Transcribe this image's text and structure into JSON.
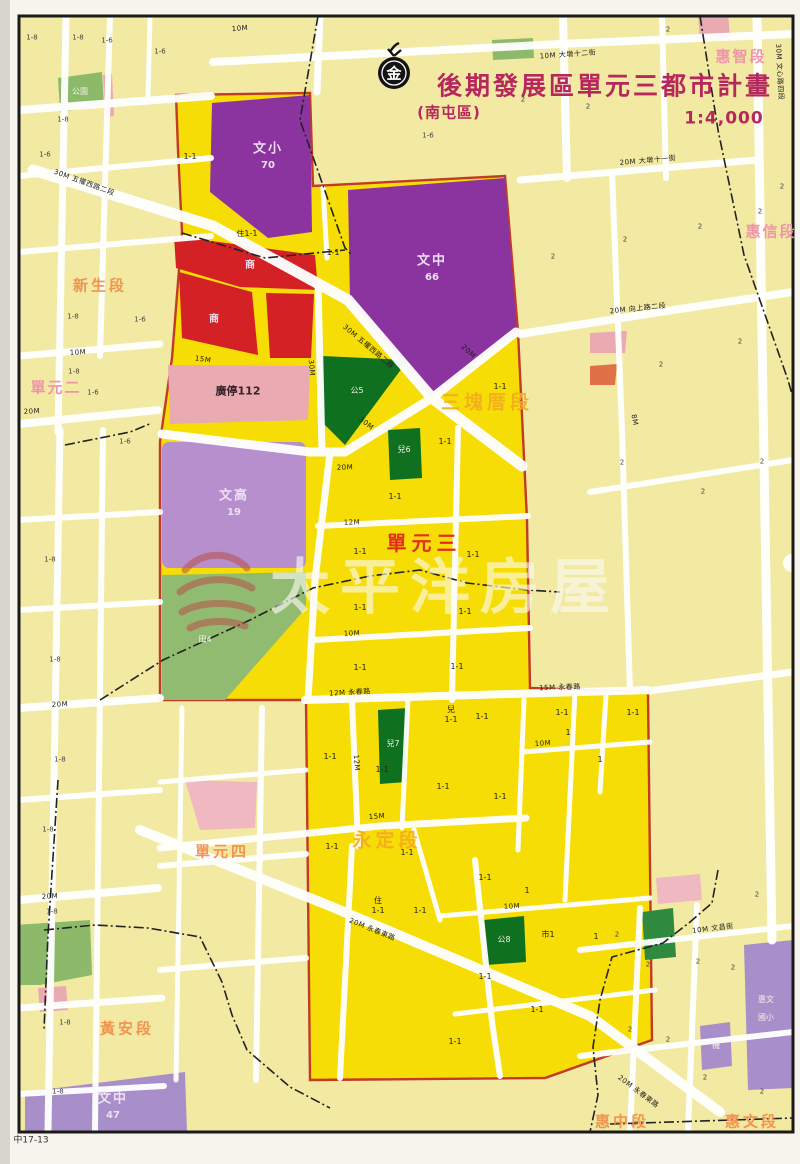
{
  "header": {
    "logo_char": "金",
    "title": "後期發展區單元三都市計畫",
    "subtitle": "(南屯區)",
    "scale": "1:4,000"
  },
  "watermark": {
    "text": "太平洋房屋"
  },
  "plate_no": "中17-13",
  "map": {
    "colors": {
      "photo_bg": "#eae8e0",
      "sheet": "#f6f4ec",
      "frame": "#1a1a1a",
      "bright": "#f6dd05",
      "pale": "#f2e9a2",
      "street": "#ffffff",
      "purple": "#8b34a0",
      "light_purple": "#b78fcd",
      "lavender": "#a98fc9",
      "red_zone": "#d42125",
      "pink_zone": "#e9aab2",
      "pink_light": "#f0b8c0",
      "dark_green": "#0f7020",
      "mid_green": "#2f8a40",
      "soft_green": "#8cba6a",
      "field_green": "#92bb72",
      "boundary_red": "#c23b28",
      "title": "#b6275c",
      "seg_orange": "#f28c4a",
      "seg_yellow": "#f3ac20",
      "seg_pink": "#ef95aa",
      "unit_red": "#e52c20",
      "watermark_logo": "#b85048"
    },
    "labels": [
      {
        "x": 605,
        "y": 86,
        "t": "後期發展區單元三都市計畫",
        "c": "ttl"
      },
      {
        "x": 449,
        "y": 113,
        "t": "(南屯區)",
        "c": "ttl2"
      },
      {
        "x": 724,
        "y": 119,
        "t": "1:4,000",
        "c": "ttl3"
      },
      {
        "x": 394,
        "y": 74,
        "t": "金",
        "c": "logo-ch"
      },
      {
        "x": 445,
        "y": 588,
        "t": "太平洋房屋",
        "c": "wm"
      },
      {
        "x": 31,
        "y": 1141,
        "t": "中17-13",
        "c": "plate"
      },
      {
        "x": 100,
        "y": 286,
        "t": "新生段",
        "c": "sg-o"
      },
      {
        "x": 56,
        "y": 388,
        "t": "單元二",
        "c": "sg-p"
      },
      {
        "x": 741,
        "y": 57,
        "t": "惠智段",
        "c": "sg-p"
      },
      {
        "x": 771,
        "y": 232,
        "t": "惠信段",
        "c": "sg-p"
      },
      {
        "x": 487,
        "y": 403,
        "t": "三塊厝段",
        "c": "sg-o2"
      },
      {
        "x": 424,
        "y": 543,
        "t": "單元三",
        "c": "sg-r"
      },
      {
        "x": 387,
        "y": 841,
        "t": "永定段",
        "c": "sg-o2"
      },
      {
        "x": 222,
        "y": 852,
        "t": "單元四",
        "c": "sg-o"
      },
      {
        "x": 127,
        "y": 1029,
        "t": "黃安段",
        "c": "sg-o"
      },
      {
        "x": 622,
        "y": 1122,
        "t": "惠中段",
        "c": "sg-o"
      },
      {
        "x": 752,
        "y": 1122,
        "t": "惠文段",
        "c": "sg-o"
      },
      {
        "x": 268,
        "y": 149,
        "t": "文小",
        "c": "wz"
      },
      {
        "x": 268,
        "y": 166,
        "t": "70",
        "c": "wz2"
      },
      {
        "x": 432,
        "y": 261,
        "t": "文中",
        "c": "wz"
      },
      {
        "x": 432,
        "y": 278,
        "t": "66",
        "c": "wz2"
      },
      {
        "x": 234,
        "y": 496,
        "t": "文高",
        "c": "wz"
      },
      {
        "x": 234,
        "y": 513,
        "t": "19",
        "c": "wz2"
      },
      {
        "x": 113,
        "y": 1099,
        "t": "文中",
        "c": "wz"
      },
      {
        "x": 113,
        "y": 1116,
        "t": "47",
        "c": "wz2"
      },
      {
        "x": 250,
        "y": 266,
        "t": "商",
        "c": "wz2"
      },
      {
        "x": 214,
        "y": 320,
        "t": "商",
        "c": "wz2"
      },
      {
        "x": 238,
        "y": 391,
        "t": "廣停112",
        "c": "pk"
      },
      {
        "x": 357,
        "y": 391,
        "t": "公5",
        "c": "wzt"
      },
      {
        "x": 404,
        "y": 450,
        "t": "兒6",
        "c": "wzt"
      },
      {
        "x": 393,
        "y": 744,
        "t": "兒7",
        "c": "wzt"
      },
      {
        "x": 504,
        "y": 940,
        "t": "公8",
        "c": "wzt"
      },
      {
        "x": 205,
        "y": 640,
        "t": "田4",
        "c": "wzt"
      },
      {
        "x": 766,
        "y": 1000,
        "t": "惠文",
        "c": "wzt"
      },
      {
        "x": 766,
        "y": 1018,
        "t": "國小",
        "c": "wzt"
      },
      {
        "x": 716,
        "y": 1046,
        "t": "機",
        "c": "wzt"
      },
      {
        "x": 80,
        "y": 92,
        "t": "公園",
        "c": "wzt"
      },
      {
        "x": 240,
        "y": 29,
        "t": "10M",
        "c": "st",
        "r": -4
      },
      {
        "x": 568,
        "y": 55,
        "t": "10M 大墩十二街",
        "c": "st",
        "r": -4
      },
      {
        "x": 84,
        "y": 183,
        "t": "30M 五權西路二段",
        "c": "st",
        "r": 20
      },
      {
        "x": 368,
        "y": 347,
        "t": "30M 五權西路二段",
        "c": "st",
        "r": 40
      },
      {
        "x": 203,
        "y": 360,
        "t": "15M",
        "c": "st",
        "r": 8
      },
      {
        "x": 311,
        "y": 368,
        "t": "30M",
        "c": "st",
        "r": 85
      },
      {
        "x": 468,
        "y": 352,
        "t": "20M",
        "c": "st",
        "r": 43
      },
      {
        "x": 366,
        "y": 424,
        "t": "30M",
        "c": "st",
        "r": 38
      },
      {
        "x": 345,
        "y": 468,
        "t": "20M",
        "c": "st",
        "r": -2
      },
      {
        "x": 352,
        "y": 523,
        "t": "12M",
        "c": "st",
        "r": -2
      },
      {
        "x": 352,
        "y": 634,
        "t": "10M",
        "c": "st",
        "r": -2
      },
      {
        "x": 350,
        "y": 693,
        "t": "12M 永春路",
        "c": "st",
        "r": -3
      },
      {
        "x": 560,
        "y": 688,
        "t": "15M 永春路",
        "c": "st",
        "r": -2
      },
      {
        "x": 356,
        "y": 763,
        "t": "12M",
        "c": "st",
        "r": 85
      },
      {
        "x": 377,
        "y": 817,
        "t": "15M",
        "c": "st",
        "r": -4
      },
      {
        "x": 543,
        "y": 744,
        "t": "10M",
        "c": "st",
        "r": -3
      },
      {
        "x": 512,
        "y": 907,
        "t": "10M",
        "c": "st",
        "r": -3
      },
      {
        "x": 372,
        "y": 930,
        "t": "20M 永春東路",
        "c": "st",
        "r": 22
      },
      {
        "x": 638,
        "y": 1092,
        "t": "20M 永春東路",
        "c": "st",
        "r": 37
      },
      {
        "x": 648,
        "y": 161,
        "t": "20M 大墩十一街",
        "c": "st",
        "r": -5
      },
      {
        "x": 638,
        "y": 309,
        "t": "20M 向上路二段",
        "c": "st",
        "r": -6
      },
      {
        "x": 779,
        "y": 72,
        "t": "30M 文心路四段",
        "c": "st",
        "r": 87
      },
      {
        "x": 634,
        "y": 420,
        "t": "8M",
        "c": "st",
        "r": 80
      },
      {
        "x": 713,
        "y": 929,
        "t": "10M 文昌街",
        "c": "st",
        "r": -7
      },
      {
        "x": 78,
        "y": 353,
        "t": "10M",
        "c": "st",
        "r": -3
      },
      {
        "x": 32,
        "y": 412,
        "t": "20M",
        "c": "st",
        "r": -3
      },
      {
        "x": 60,
        "y": 705,
        "t": "20M",
        "c": "st",
        "r": -3
      },
      {
        "x": 50,
        "y": 897,
        "t": "20M",
        "c": "st",
        "r": -3
      },
      {
        "x": 247,
        "y": 234,
        "t": "住1-1",
        "c": "blk",
        "r": -2
      },
      {
        "x": 190,
        "y": 157,
        "t": "1-1",
        "c": "blk"
      },
      {
        "x": 333,
        "y": 253,
        "t": "1-1",
        "c": "blk"
      },
      {
        "x": 500,
        "y": 387,
        "t": "1-1",
        "c": "blk"
      },
      {
        "x": 445,
        "y": 442,
        "t": "1-1",
        "c": "blk"
      },
      {
        "x": 395,
        "y": 497,
        "t": "1-1",
        "c": "blk"
      },
      {
        "x": 360,
        "y": 552,
        "t": "1-1",
        "c": "blk"
      },
      {
        "x": 473,
        "y": 555,
        "t": "1-1",
        "c": "blk"
      },
      {
        "x": 360,
        "y": 608,
        "t": "1-1",
        "c": "blk"
      },
      {
        "x": 465,
        "y": 612,
        "t": "1-1",
        "c": "blk"
      },
      {
        "x": 360,
        "y": 668,
        "t": "1-1",
        "c": "blk"
      },
      {
        "x": 457,
        "y": 667,
        "t": "1-1",
        "c": "blk"
      },
      {
        "x": 330,
        "y": 757,
        "t": "1-1",
        "c": "blk"
      },
      {
        "x": 382,
        "y": 770,
        "t": "1-1",
        "c": "blk"
      },
      {
        "x": 443,
        "y": 787,
        "t": "1-1",
        "c": "blk"
      },
      {
        "x": 500,
        "y": 797,
        "t": "1-1",
        "c": "blk"
      },
      {
        "x": 332,
        "y": 847,
        "t": "1-1",
        "c": "blk"
      },
      {
        "x": 482,
        "y": 717,
        "t": "1-1",
        "c": "blk"
      },
      {
        "x": 451,
        "y": 710,
        "t": "兒",
        "c": "blk"
      },
      {
        "x": 451,
        "y": 720,
        "t": "1-1",
        "c": "blk"
      },
      {
        "x": 407,
        "y": 853,
        "t": "1-1",
        "c": "blk"
      },
      {
        "x": 562,
        "y": 713,
        "t": "1-1",
        "c": "blk"
      },
      {
        "x": 568,
        "y": 733,
        "t": "1",
        "c": "blk"
      },
      {
        "x": 633,
        "y": 713,
        "t": "1-1",
        "c": "blk"
      },
      {
        "x": 600,
        "y": 760,
        "t": "1",
        "c": "blk"
      },
      {
        "x": 485,
        "y": 878,
        "t": "1-1",
        "c": "blk"
      },
      {
        "x": 527,
        "y": 891,
        "t": "1",
        "c": "blk"
      },
      {
        "x": 420,
        "y": 911,
        "t": "1-1",
        "c": "blk"
      },
      {
        "x": 378,
        "y": 901,
        "t": "住",
        "c": "blk"
      },
      {
        "x": 378,
        "y": 911,
        "t": "1-1",
        "c": "blk"
      },
      {
        "x": 548,
        "y": 935,
        "t": "市1",
        "c": "blk"
      },
      {
        "x": 596,
        "y": 937,
        "t": "1",
        "c": "blk"
      },
      {
        "x": 485,
        "y": 977,
        "t": "1-1",
        "c": "blk"
      },
      {
        "x": 537,
        "y": 1010,
        "t": "1-1",
        "c": "blk"
      },
      {
        "x": 455,
        "y": 1042,
        "t": "1-1",
        "c": "blk"
      },
      {
        "x": 32,
        "y": 38,
        "t": "1-8",
        "c": "blk2"
      },
      {
        "x": 78,
        "y": 38,
        "t": "1-8",
        "c": "blk2"
      },
      {
        "x": 107,
        "y": 41,
        "t": "1-6",
        "c": "blk2"
      },
      {
        "x": 160,
        "y": 52,
        "t": "1-6",
        "c": "blk2"
      },
      {
        "x": 63,
        "y": 120,
        "t": "1-8",
        "c": "blk2"
      },
      {
        "x": 45,
        "y": 155,
        "t": "1-6",
        "c": "blk2"
      },
      {
        "x": 428,
        "y": 136,
        "t": "1-6",
        "c": "blk2"
      },
      {
        "x": 523,
        "y": 100,
        "t": "2",
        "c": "blk2"
      },
      {
        "x": 588,
        "y": 107,
        "t": "2",
        "c": "blk2"
      },
      {
        "x": 73,
        "y": 317,
        "t": "1-8",
        "c": "blk2"
      },
      {
        "x": 140,
        "y": 320,
        "t": "1-6",
        "c": "blk2"
      },
      {
        "x": 74,
        "y": 372,
        "t": "1-8",
        "c": "blk2"
      },
      {
        "x": 93,
        "y": 393,
        "t": "1-6",
        "c": "blk2"
      },
      {
        "x": 125,
        "y": 442,
        "t": "1-6",
        "c": "blk2"
      },
      {
        "x": 50,
        "y": 560,
        "t": "1-8",
        "c": "blk2"
      },
      {
        "x": 55,
        "y": 660,
        "t": "1-8",
        "c": "blk2"
      },
      {
        "x": 60,
        "y": 760,
        "t": "1-8",
        "c": "blk2"
      },
      {
        "x": 48,
        "y": 830,
        "t": "1-8",
        "c": "blk2"
      },
      {
        "x": 52,
        "y": 912,
        "t": "1-8",
        "c": "blk2"
      },
      {
        "x": 65,
        "y": 1023,
        "t": "1-8",
        "c": "blk2"
      },
      {
        "x": 58,
        "y": 1092,
        "t": "1-8",
        "c": "blk2"
      },
      {
        "x": 553,
        "y": 257,
        "t": "2",
        "c": "blk2"
      },
      {
        "x": 668,
        "y": 30,
        "t": "2",
        "c": "blk2"
      },
      {
        "x": 782,
        "y": 187,
        "t": "2",
        "c": "blk2"
      },
      {
        "x": 760,
        "y": 212,
        "t": "2",
        "c": "blk2"
      },
      {
        "x": 700,
        "y": 227,
        "t": "2",
        "c": "blk2"
      },
      {
        "x": 625,
        "y": 240,
        "t": "2",
        "c": "blk2"
      },
      {
        "x": 661,
        "y": 365,
        "t": "2",
        "c": "blk2"
      },
      {
        "x": 740,
        "y": 342,
        "t": "2",
        "c": "blk2"
      },
      {
        "x": 622,
        "y": 463,
        "t": "2",
        "c": "blk2"
      },
      {
        "x": 703,
        "y": 492,
        "t": "2",
        "c": "blk2"
      },
      {
        "x": 762,
        "y": 462,
        "t": "2",
        "c": "blk2"
      },
      {
        "x": 617,
        "y": 935,
        "t": "2",
        "c": "blk2"
      },
      {
        "x": 648,
        "y": 965,
        "t": "2",
        "c": "blk2"
      },
      {
        "x": 698,
        "y": 962,
        "t": "2",
        "c": "blk2"
      },
      {
        "x": 733,
        "y": 968,
        "t": "2",
        "c": "blk2"
      },
      {
        "x": 630,
        "y": 1030,
        "t": "2",
        "c": "blk2"
      },
      {
        "x": 668,
        "y": 1040,
        "t": "2",
        "c": "blk2"
      },
      {
        "x": 705,
        "y": 1078,
        "t": "2",
        "c": "blk2"
      },
      {
        "x": 762,
        "y": 1092,
        "t": "2",
        "c": "blk2"
      },
      {
        "x": 757,
        "y": 895,
        "t": "2",
        "c": "blk2"
      }
    ]
  }
}
